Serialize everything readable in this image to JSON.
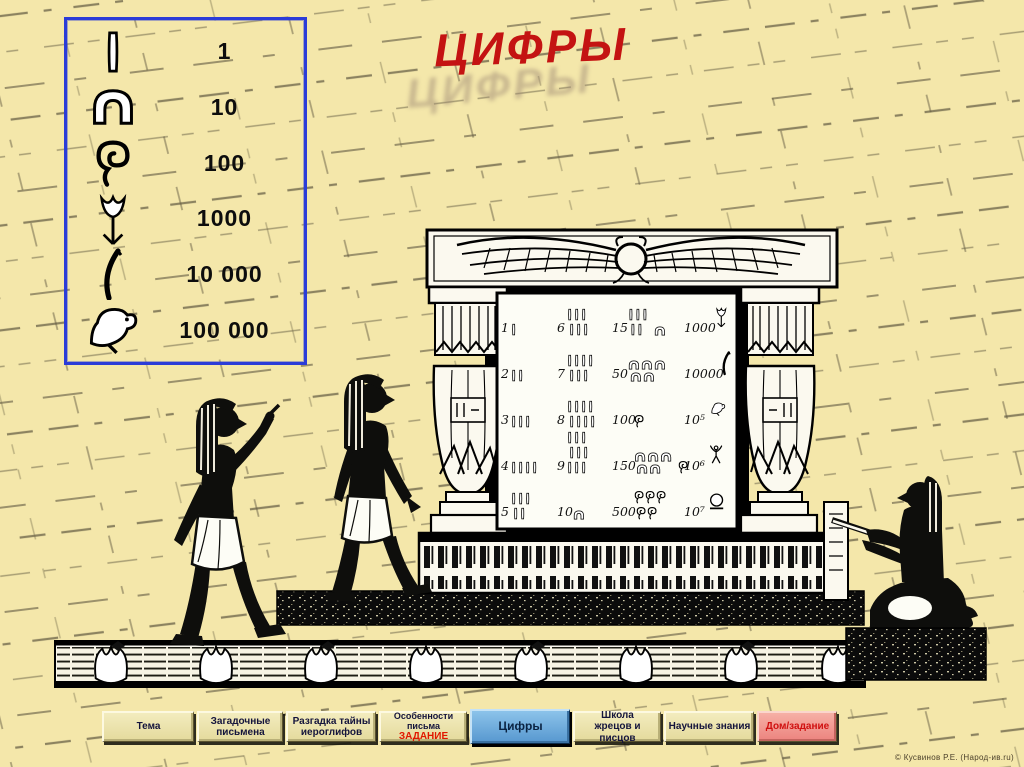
{
  "title": {
    "text": "ЦИФРЫ"
  },
  "legend": {
    "name": "egyptian-numerals-legend",
    "items": [
      {
        "glyph": "stroke",
        "icon": "vertical-stroke-hieroglyph",
        "value": "1"
      },
      {
        "glyph": "arch",
        "icon": "heel-bone-arch-hieroglyph",
        "value": "10"
      },
      {
        "glyph": "coil",
        "icon": "rope-coil-hieroglyph",
        "value": "100"
      },
      {
        "glyph": "lotus",
        "icon": "lotus-flower-hieroglyph",
        "value": "1000"
      },
      {
        "glyph": "finger",
        "icon": "bent-finger-hieroglyph",
        "value": "10 000"
      },
      {
        "glyph": "tadpole",
        "icon": "tadpole-bird-hieroglyph",
        "value": "100 000"
      }
    ]
  },
  "tablet": {
    "name": "stone-tablet-number-table",
    "rows": [
      {
        "cells": [
          {
            "label": "1",
            "glyphs": [
              {
                "g": "stroke",
                "n": 1
              }
            ]
          },
          {
            "label": "6",
            "glyphs": [
              {
                "g": "stroke",
                "n": 6
              }
            ]
          },
          {
            "label": "15",
            "glyphs": [
              {
                "g": "stroke",
                "n": 5
              },
              {
                "g": "arch",
                "n": 1
              }
            ]
          },
          {
            "label": "1000",
            "glyphs": [
              {
                "g": "lotus",
                "n": 1
              }
            ]
          }
        ]
      },
      {
        "cells": [
          {
            "label": "2",
            "glyphs": [
              {
                "g": "stroke",
                "n": 2
              }
            ]
          },
          {
            "label": "7",
            "glyphs": [
              {
                "g": "stroke",
                "n": 7
              }
            ]
          },
          {
            "label": "50",
            "glyphs": [
              {
                "g": "arch",
                "n": 5
              }
            ]
          },
          {
            "label": "10000",
            "glyphs": [
              {
                "g": "finger",
                "n": 1
              }
            ]
          }
        ]
      },
      {
        "cells": [
          {
            "label": "3",
            "glyphs": [
              {
                "g": "stroke",
                "n": 3
              }
            ]
          },
          {
            "label": "8",
            "glyphs": [
              {
                "g": "stroke",
                "n": 8
              }
            ]
          },
          {
            "label": "100",
            "glyphs": [
              {
                "g": "coil",
                "n": 1
              }
            ]
          },
          {
            "label": "10⁵",
            "glyphs": [
              {
                "g": "tadpole",
                "n": 1
              }
            ]
          }
        ]
      },
      {
        "cells": [
          {
            "label": "4",
            "glyphs": [
              {
                "g": "stroke",
                "n": 4
              }
            ]
          },
          {
            "label": "9",
            "glyphs": [
              {
                "g": "stroke",
                "n": 9
              }
            ]
          },
          {
            "label": "150",
            "glyphs": [
              {
                "g": "arch",
                "n": 5
              },
              {
                "g": "coil",
                "n": 1
              }
            ]
          },
          {
            "label": "10⁶",
            "glyphs": [
              {
                "g": "heh",
                "n": 1
              }
            ]
          }
        ]
      },
      {
        "cells": [
          {
            "label": "5",
            "glyphs": [
              {
                "g": "stroke",
                "n": 5
              }
            ]
          },
          {
            "label": "10",
            "glyphs": [
              {
                "g": "arch",
                "n": 1
              }
            ]
          },
          {
            "label": "500",
            "glyphs": [
              {
                "g": "coil",
                "n": 5
              }
            ]
          },
          {
            "label": "10⁷",
            "glyphs": [
              {
                "g": "sun",
                "n": 1
              }
            ]
          }
        ]
      }
    ]
  },
  "illustration": {
    "name": "egyptian-monument-scene",
    "elements": [
      "winged-sun-disk",
      "papyrus-columns",
      "numbers-tablet",
      "standing-egyptian-pointing",
      "standing-egyptian",
      "seated-scribe",
      "lotus-frieze"
    ]
  },
  "nav": {
    "buttons": [
      {
        "id": "tema",
        "label": "Тема"
      },
      {
        "id": "zagadochnye",
        "label": "Загадочные\nписьмена"
      },
      {
        "id": "razgadka",
        "label": "Разгадка тайны\nиероглифов"
      },
      {
        "id": "osobennosti",
        "label": "Особенности письма",
        "sub": "ЗАДАНИЕ"
      },
      {
        "id": "tsifry",
        "label": "Цифры",
        "active": true
      },
      {
        "id": "shkola",
        "label": "Школа\nжрецов и писцов"
      },
      {
        "id": "nauchnye",
        "label": "Научные знания"
      },
      {
        "id": "dom-zadanie",
        "label": "Дом/задание",
        "variant": "pink"
      }
    ]
  },
  "credit": {
    "text": "© Кусвинов Р.Е. (Народ-ив.ru)"
  },
  "colors": {
    "background": "#f4e7aa",
    "title_red": "#c41312",
    "legend_border_blue": "#2b3cd8",
    "active_button_blue": "#5697cf",
    "homework_pink": "#ec837e",
    "homework_text_red": "#d01010"
  }
}
